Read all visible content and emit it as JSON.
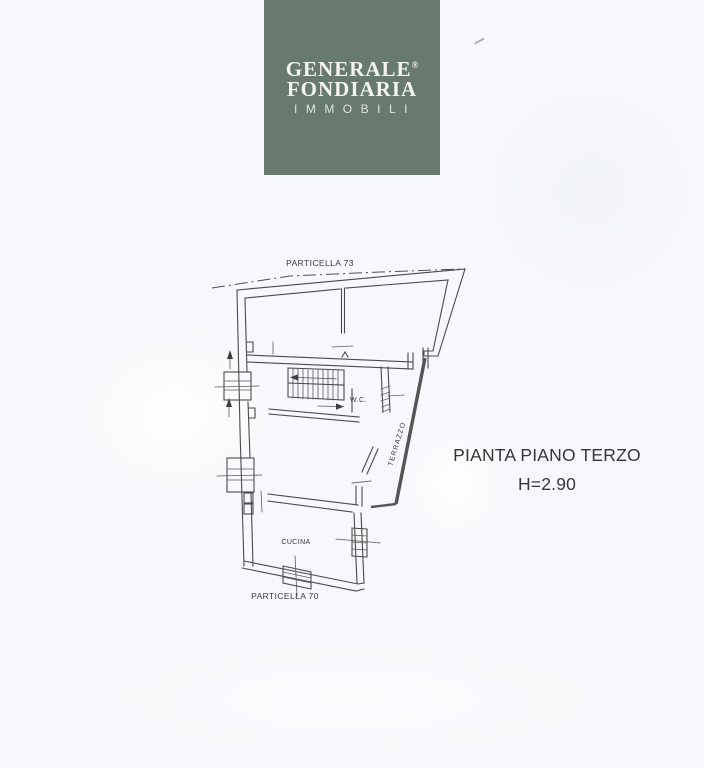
{
  "colors": {
    "logo_background": "#68796e",
    "logo_text": "#f5f5f0",
    "paper_background": "#f6f8fb",
    "plan_line_color": "#4a4a4a",
    "caption_text_color": "#363636"
  },
  "logo": {
    "line1": "GENERALE",
    "registered": "®",
    "line2": "FONDIARIA",
    "line3": "IMMOBILI"
  },
  "floor_plan": {
    "parcel_label_top": "PARTICELLA 73",
    "parcel_label_bottom": "PARTICELLA 70",
    "room_wc": "W.C.",
    "room_terrace": "TERRAZZO",
    "room_kitchen": "CUCINA"
  },
  "caption": {
    "title": "PIANTA PIANO TERZO",
    "height": "H=2.90"
  }
}
